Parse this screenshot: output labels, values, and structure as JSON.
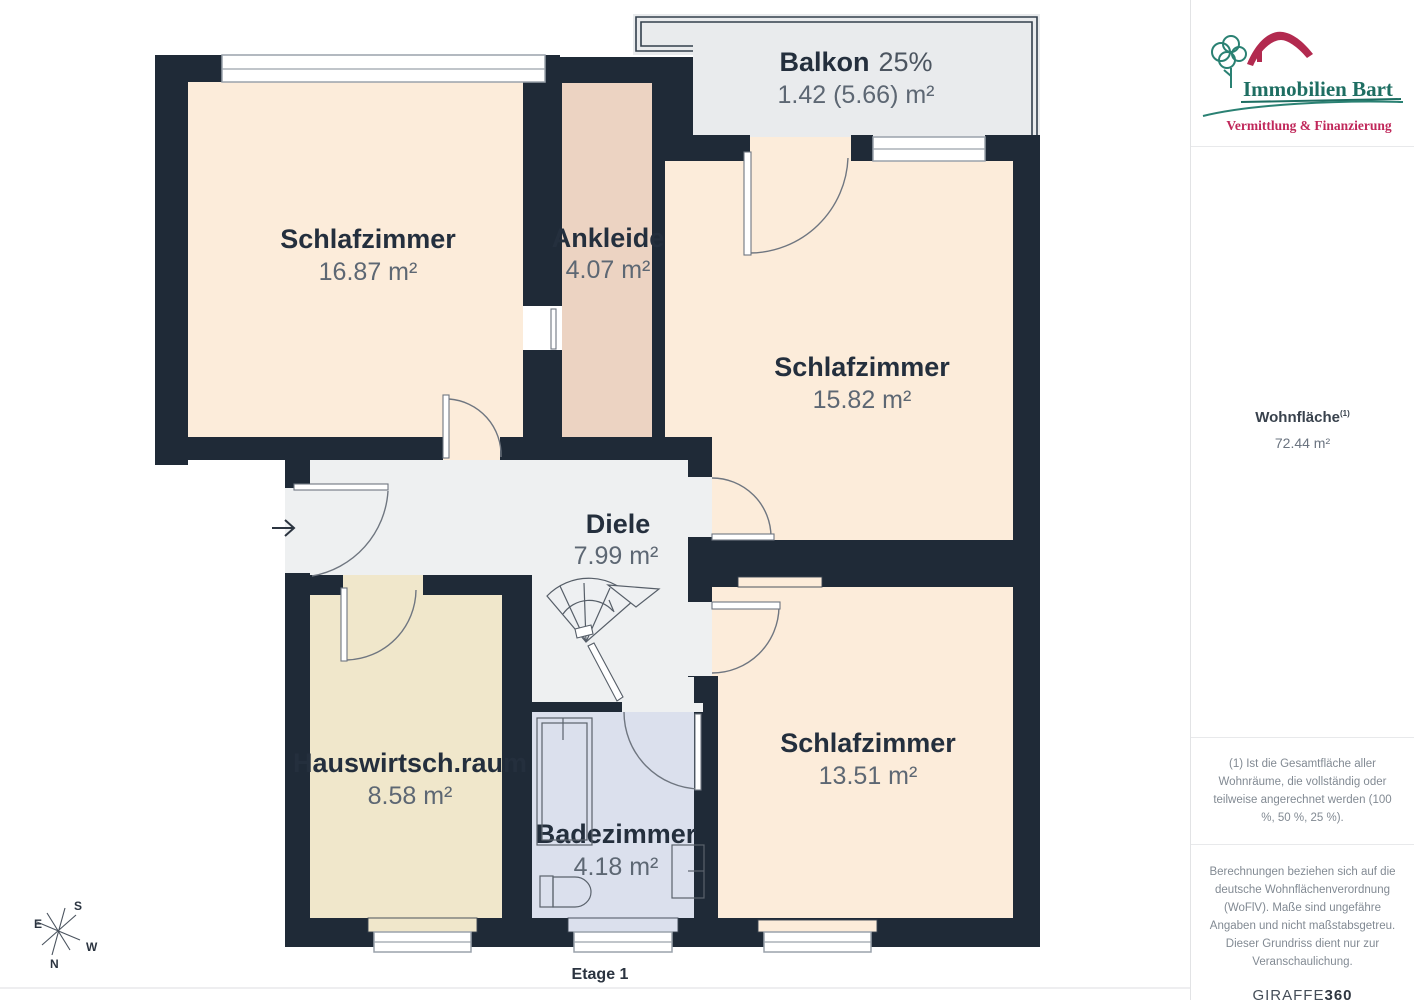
{
  "plan": {
    "rooms": [
      {
        "name": "Schlafzimmer",
        "area": "16.87 m²"
      },
      {
        "name": "Ankleide",
        "area": "4.07 m²"
      },
      {
        "name": "Schlafzimmer",
        "area": "15.82 m²"
      },
      {
        "name": "Diele",
        "area": "7.99 m²"
      },
      {
        "name": "Hauswirtsch.raum",
        "area": "8.58 m²"
      },
      {
        "name": "Badezimmer",
        "area": "4.18 m²"
      },
      {
        "name": "Schlafzimmer",
        "area": "13.51 m²"
      }
    ],
    "balcony": {
      "label": "Balkon",
      "percent": "25%",
      "area": "1.42 (5.66) m²"
    },
    "floor_label": "Etage 1",
    "compass": {
      "n": "N",
      "s": "S",
      "e": "E",
      "w": "W"
    }
  },
  "sidebar": {
    "logo": {
      "title": "Immobilien Bart",
      "tagline": "Vermittlung & Finanzierung"
    },
    "living_area": {
      "label": "Wohnfläche",
      "superscript": "(1)",
      "value": "72.44 m²"
    },
    "footnote": "(1) Ist die Gesamtfläche aller Wohnräume, die vollständig oder teilweise angerechnet werden (100 %, 50 %, 25 %).",
    "disclaimer": "Berechnungen beziehen sich auf die deutsche Wohnflächenverordnung (WoFlV). Maße sind ungefähre Angaben und nicht maßstabsgetreu. Dieser Grundriss dient nur zur Veranschaulichung.",
    "brand": {
      "name": "GIRAFFE",
      "suffix": "360"
    }
  },
  "colors": {
    "wall": "#1f2a37",
    "room_peach": "#fcecda",
    "room_pink": "#ecd3c2",
    "room_beige": "#f0e7cb",
    "room_blue": "#dbe0ed",
    "hall_gray": "#eef0f1",
    "balcony_gray": "#e9ebed",
    "logo_green": "#1e6e62",
    "logo_red": "#b22a4f",
    "tagline_red": "#c0275a"
  }
}
